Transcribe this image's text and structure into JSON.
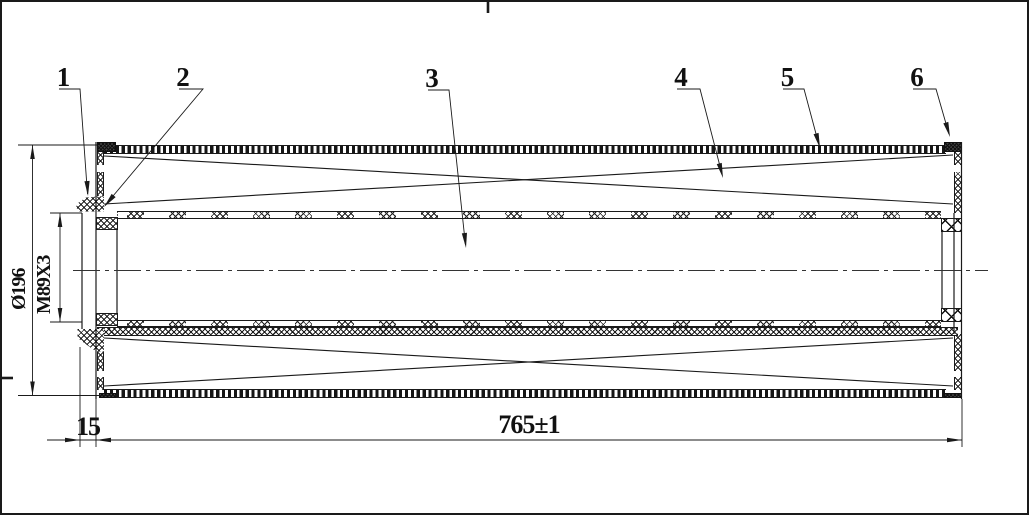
{
  "drawing": {
    "background": "#ffffff",
    "line_color": "#1a1a1a"
  },
  "callouts": [
    "1",
    "2",
    "3",
    "4",
    "5",
    "6"
  ],
  "dimensions": {
    "outer_diameter": "Ø196",
    "thread_spec": "M89X3",
    "neck_length": "15",
    "overall_length": "765±1"
  }
}
